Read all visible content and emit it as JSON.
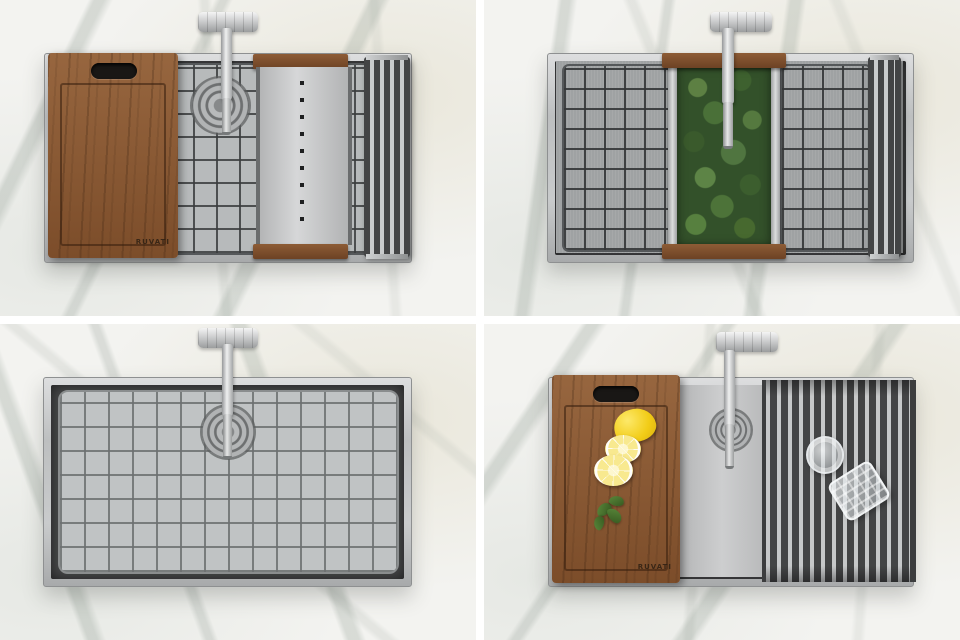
{
  "brand": {
    "label": "RUVATI"
  },
  "objects": {
    "faucet": "chrome-faucet-top-view",
    "drain": "round-drain",
    "cutting_board": "walnut-cutting-board",
    "colander": "over-sink-colander-wood-handles",
    "bottom_grid": "stainless-bottom-rinse-grid",
    "roll_up_rack": "roll-up-drying-rack",
    "basil": "fresh-basil-leaves",
    "lemon": "lemon-half-and-slices",
    "glassware": "glass-lid-and-tumbler"
  },
  "colors": {
    "marble-base": "#f3f3f0",
    "basin": "#48494a",
    "grid-floor": "#b7babb",
    "mesh": "#9fa2a3",
    "wood": "#97663f",
    "wood-dark": "#7c4d2a",
    "basil": "#33512a",
    "lemon": "#f2cc17",
    "rack-dark": "#434445",
    "rack-bar": "#c6c8c9"
  }
}
